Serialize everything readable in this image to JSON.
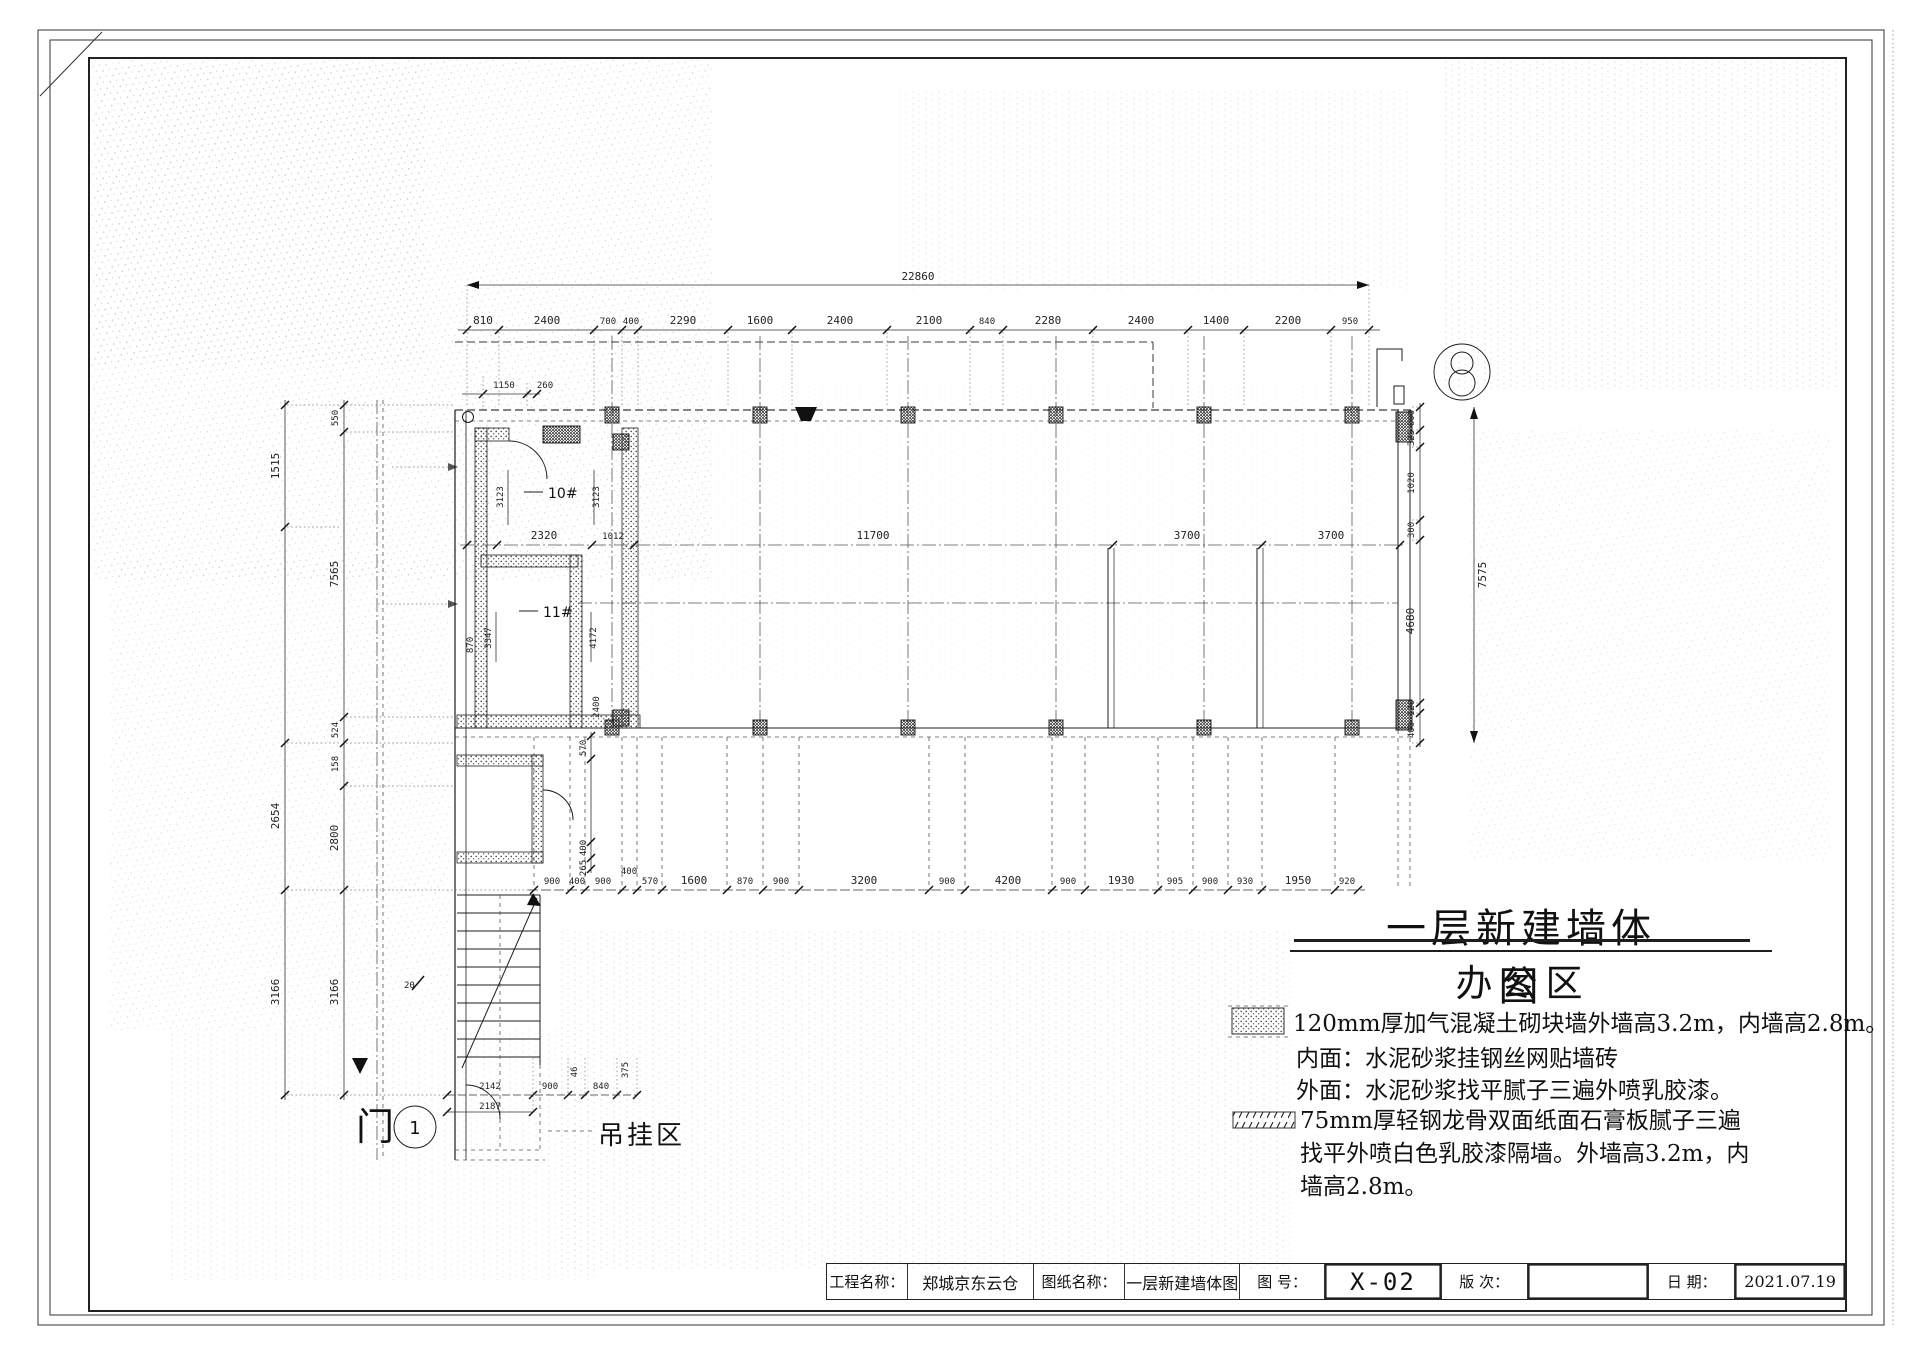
{
  "sheet": {
    "main_title": "一层新建墙体图",
    "sub_title": "办公区",
    "area_label": "吊挂区",
    "door_label": "门",
    "door_number": "1"
  },
  "notes": {
    "note1_line1": "120mm厚加气混凝土砌块墙外墙高3.2m，内墙高2.8m。",
    "note1_line2": "内面：水泥砂浆挂钢丝网贴墙砖",
    "note1_line3": "外面：水泥砂浆找平腻子三遍外喷乳胶漆。",
    "note2_line1": "75mm厚轻钢龙骨双面纸面石膏板腻子三遍",
    "note2_line2": "找平外喷白色乳胶漆隔墙。外墙高3.2m，内",
    "note2_line3": "墙高2.8m。"
  },
  "title_block": {
    "project_label": "工程名称：",
    "project_value": "郑城京东云仓",
    "drawing_label": "图纸名称：",
    "drawing_value": "一层新建墙体图",
    "number_label": "图  号：",
    "number_value": "X-02",
    "revision_label": "版  次：",
    "revision_value": "",
    "date_label": "日  期：",
    "date_value": "2021.07.19"
  },
  "rooms": {
    "r1": "10#",
    "r2": "11#"
  },
  "dims": {
    "overall_top": "22860",
    "top_chain": [
      "810",
      "2400",
      "700",
      "400",
      "2290",
      "1600",
      "2400",
      "2100",
      "840",
      "2280",
      "2400",
      "1400",
      "2200",
      "950"
    ],
    "mid_chain": [
      "2320",
      "1012",
      "11700",
      "3700",
      "3700"
    ],
    "bottom_chain": [
      "900",
      "400",
      "900",
      "400",
      "570",
      "1600",
      "870",
      "900",
      "3200",
      "900",
      "4200",
      "900",
      "1930",
      "905",
      "900",
      "930",
      "1950",
      "920"
    ],
    "left_inner": [
      "550",
      "7565",
      "524",
      "158",
      "2800",
      "3166"
    ],
    "left_outer": [
      "1515",
      "2654",
      "3166"
    ],
    "right_chain": [
      "600",
      "325",
      "1020",
      "300",
      "4680",
      "120",
      "400"
    ],
    "right_overall": "7575",
    "top_left_a": "1150",
    "top_left_b": "260",
    "room": {
      "w1": "3123",
      "w2": "3123",
      "h1": "3347",
      "h2": "4172",
      "h3": "2400",
      "v1": "570",
      "v2": "400",
      "v3": "265",
      "v4": "870"
    },
    "stair": {
      "a": "2142",
      "b": "900",
      "c": "840",
      "d": "2187",
      "e": "46",
      "f": "375"
    },
    "elev": "20"
  }
}
